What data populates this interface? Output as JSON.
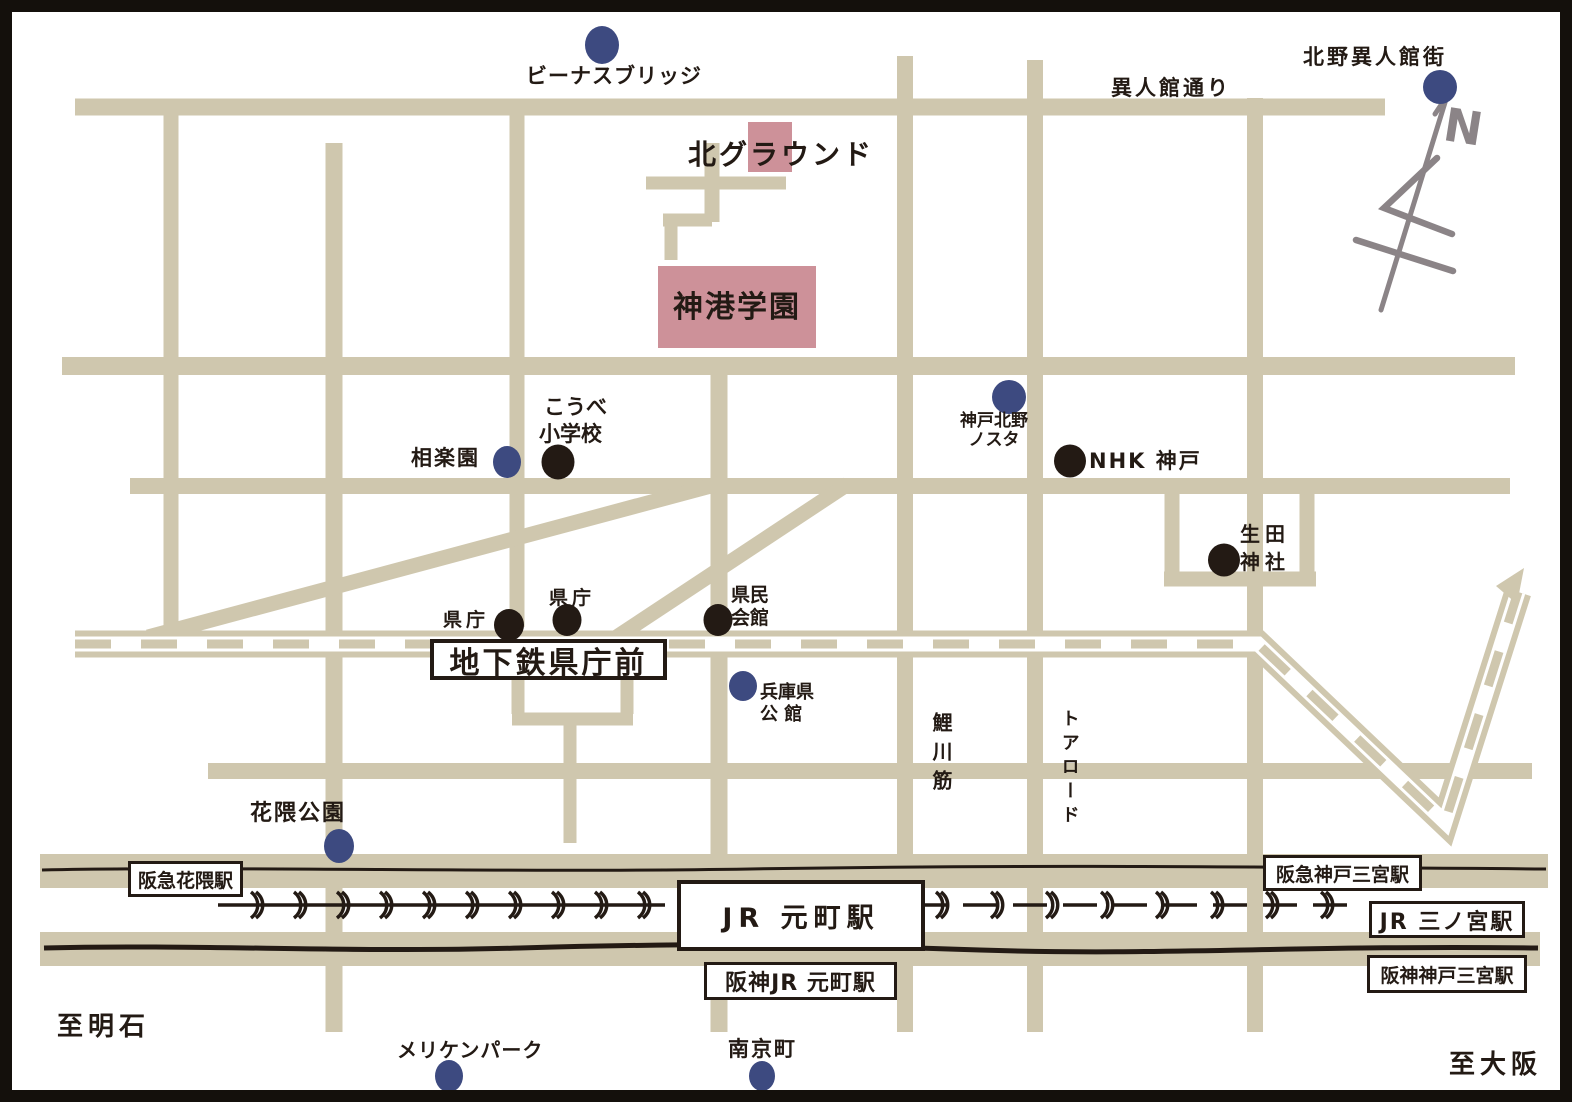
{
  "colors": {
    "road": "#cfc7ae",
    "building": "#cd9199",
    "marker_blue": "#3d4a80",
    "ink": "#231a14",
    "compass": "#8b8487"
  },
  "landmarks": {
    "venus_bridge": {
      "label": "ビーナスブリッジ",
      "marker": "blue"
    },
    "kitano_ijinkangai": {
      "label": "北野異人館街",
      "marker": "blue"
    },
    "kita_ground": {
      "label": "北グラウンド",
      "marker": "none"
    },
    "shinko_gakuen": {
      "label": "神港学園",
      "marker": "none"
    },
    "kobe_elementary": {
      "line1": "こうべ",
      "line2": "小学校",
      "marker": "black"
    },
    "sorakuen": {
      "label": "相楽園",
      "marker": "blue"
    },
    "kobe_kitano_nosuta": {
      "line1": "神戸北野",
      "line2": "ノスタ",
      "marker": "blue"
    },
    "nhk_kobe": {
      "label": "NHK 神戸",
      "marker": "black"
    },
    "ikuta_jinja": {
      "line1": "生田",
      "line2": "神社",
      "marker": "black"
    },
    "kencho_west": {
      "label": "県庁",
      "marker": "black"
    },
    "kencho_east": {
      "label": "県庁",
      "marker": "black"
    },
    "kenmin_kaikan": {
      "line1": "県民",
      "line2": "会館",
      "marker": "black"
    },
    "hyogo_kenkokan": {
      "line1": "兵庫県",
      "line2": "公 館",
      "marker": "blue"
    },
    "hanakuma_koen": {
      "label": "花隈公園",
      "marker": "blue"
    },
    "meriken_park": {
      "label": "メリケンパーク",
      "marker": "blue"
    },
    "nankinmachi": {
      "label": "南京町",
      "marker": "blue"
    }
  },
  "streets": {
    "ijinkan_dori": {
      "label": "異人館通り"
    },
    "koikawa_suji": {
      "label": "鯉川筋"
    },
    "tor_road": {
      "label": "トアロード"
    }
  },
  "stations": {
    "chikatetsu_kenchomae": {
      "label": "地下鉄県庁前"
    },
    "hankyu_hanakuma": {
      "label": "阪急花隈駅"
    },
    "jr_motomachi": {
      "label": "JR 元町駅"
    },
    "hanshin_jr_motomachi": {
      "label": "阪神JR 元町駅"
    },
    "hankyu_kobe_sannomiya": {
      "label": "阪急神戸三宮駅"
    },
    "jr_sannomiya": {
      "label": "JR 三ノ宮駅"
    },
    "hanshin_kobe_sannomiya": {
      "label": "阪神神戸三宮駅"
    }
  },
  "directions": {
    "west": {
      "label": "至明石"
    },
    "east": {
      "label": "至大阪"
    }
  },
  "compass": {
    "label": "N"
  }
}
